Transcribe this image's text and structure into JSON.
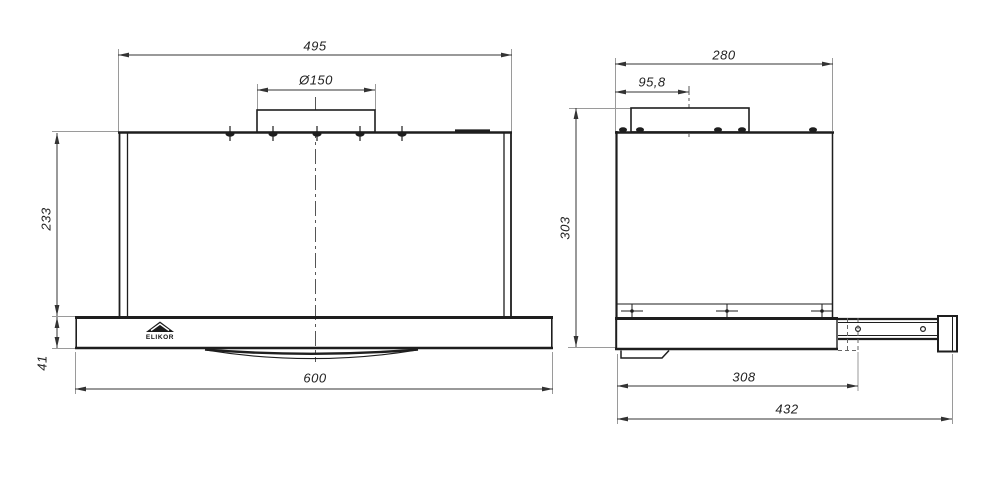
{
  "drawing_type": "cooker-hood-installation-dimensions",
  "front_view": {
    "dim_top_width": "495",
    "dim_duct_diameter": "Ø150",
    "dim_body_height": "233",
    "dim_panel_height": "41",
    "dim_total_width": "600",
    "logo_text": "ELIKOR"
  },
  "side_view": {
    "dim_top_depth": "280",
    "dim_duct_offset": "95,8",
    "dim_total_height": "303",
    "dim_body_depth": "308",
    "dim_total_depth": "432"
  },
  "colors": {
    "line": "#1e1e1e",
    "dim_line": "#333333",
    "extension_line": "#9a9a9a",
    "centerline": "#555555",
    "background": "#ffffff",
    "text": "#222222"
  }
}
